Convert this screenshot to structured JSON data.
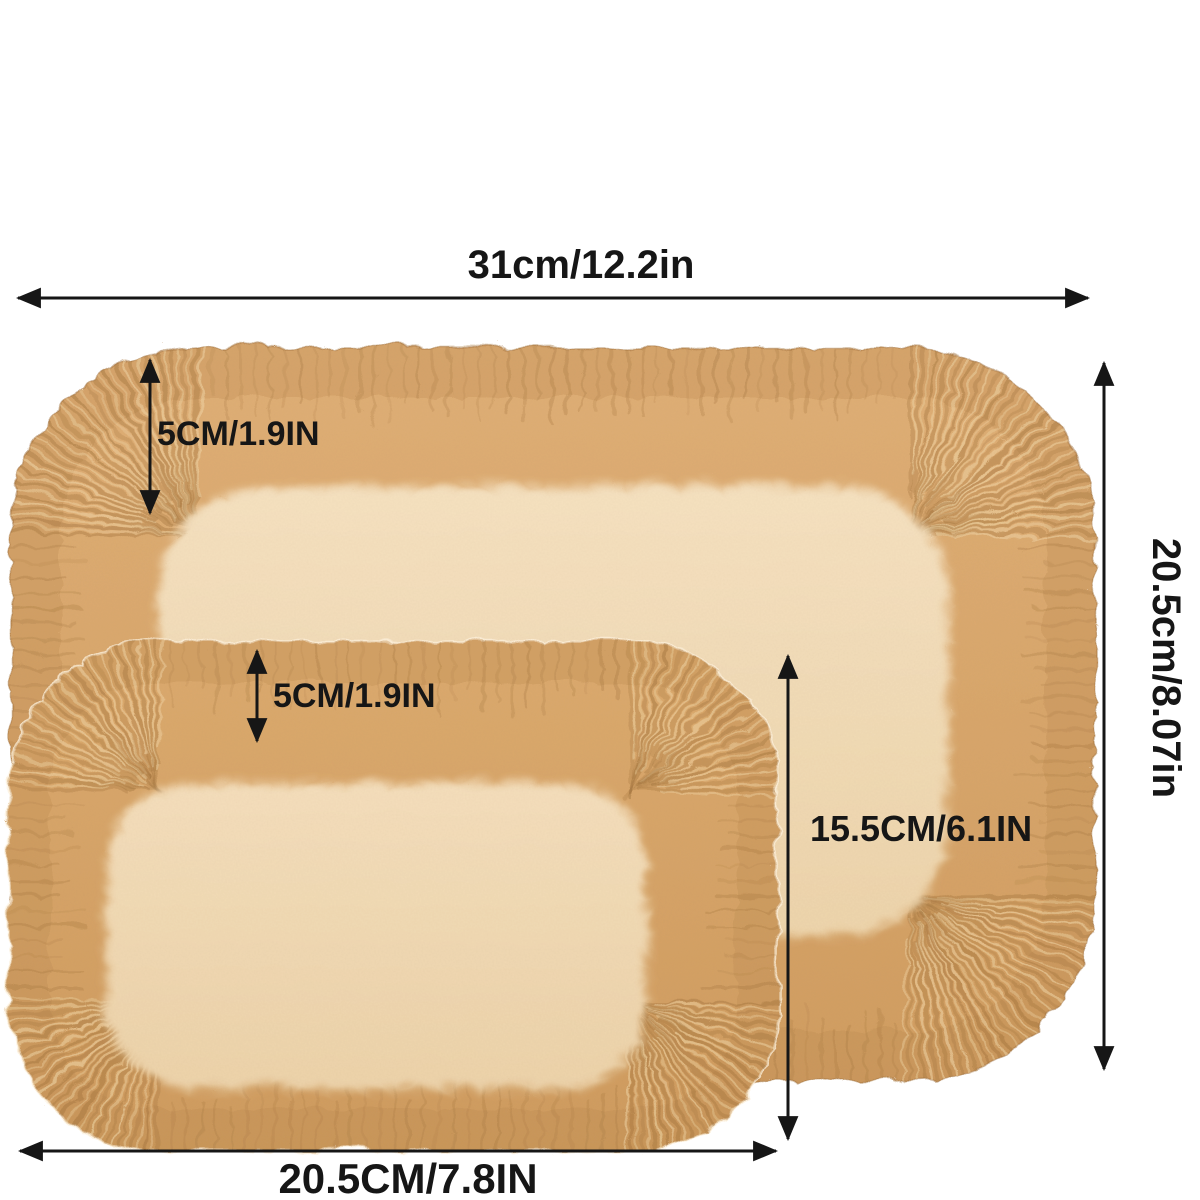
{
  "diagram": {
    "labels": {
      "top_width": "31cm/12.2in",
      "large_rim_depth": "5CM/1.9IN",
      "small_rim_depth": "5CM/1.9IN",
      "inner_height": "15.5CM/6.1IN",
      "side_height": "20.5cm/8.07in",
      "bottom_width": "20.5CM/7.8IN"
    },
    "colors": {
      "background": "#ffffff",
      "dimension": "#161616",
      "rim_large_top": "#e0af76",
      "rim_large_bottom": "#d19d60",
      "rim_small_top": "#dcaa6e",
      "rim_small_bottom": "#cf9b5e",
      "base_large_top": "#f6e2c1",
      "base_large_bottom": "#eed5ac",
      "base_small_top": "#f5dfbc",
      "base_small_bottom": "#edd3aa",
      "rim_shade": "#b9874e",
      "pleat_dark": "#9c6d36",
      "pleat_light": "#f0d5a6"
    }
  }
}
